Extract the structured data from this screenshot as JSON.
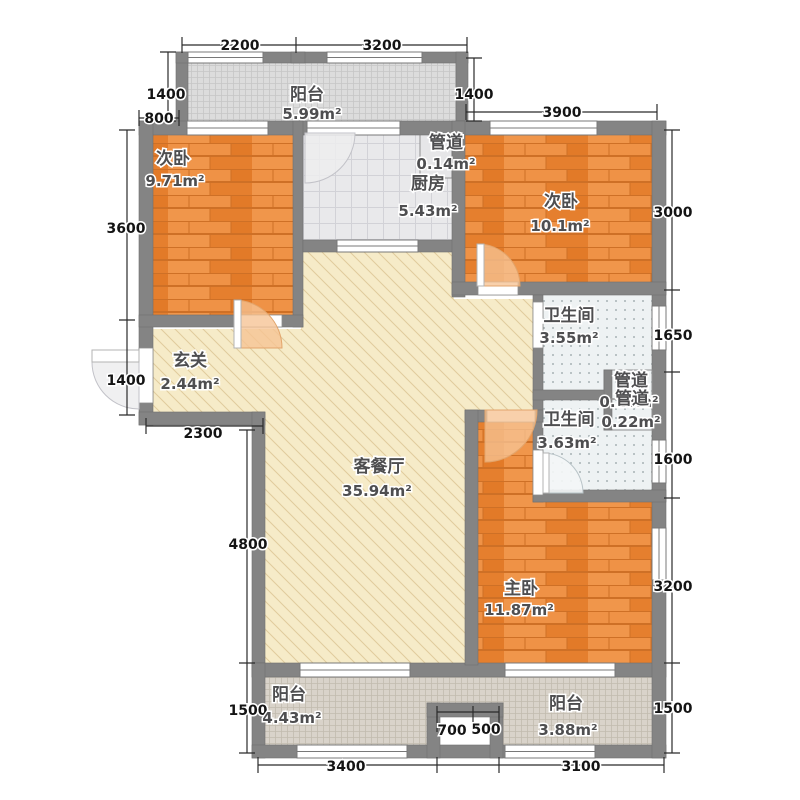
{
  "rooms": {
    "balcony_top": {
      "name": "阳台",
      "area": "5.99m²"
    },
    "bedroom_left": {
      "name": "次卧",
      "area": "9.71m²"
    },
    "duct_kitchen": {
      "name": "管道",
      "area": "0.14m²"
    },
    "kitchen": {
      "name": "厨房",
      "area": "5.43m²"
    },
    "bedroom_right": {
      "name": "次卧",
      "area": "10.1m²"
    },
    "bath_upper": {
      "name": "卫生间",
      "area": "3.55m²"
    },
    "duct_upper": {
      "name": "管道",
      "area": "0.18m²"
    },
    "duct_lower": {
      "name": "管道",
      "area": "0.22m²"
    },
    "bath_lower": {
      "name": "卫生间",
      "area": "3.63m²"
    },
    "entry": {
      "name": "玄关",
      "area": "2.44m²"
    },
    "living": {
      "name": "客餐厅",
      "area": "35.94m²"
    },
    "master": {
      "name": "主卧",
      "area": "11.87m²"
    },
    "balcony_bottom_left": {
      "name": "阳台",
      "area": "4.43m²"
    },
    "balcony_bottom_right": {
      "name": "阳台",
      "area": "3.88m²"
    }
  },
  "dims": {
    "top_left_w": "2200",
    "top_right_w": "3200",
    "balcony_left_h": "1400",
    "left_offset": "800",
    "bedroom_right_w": "3900",
    "balcony_right_h": "1400",
    "bedroom_left_h": "3600",
    "entry_left_h": "1400",
    "entry_w": "2300",
    "living_left_h": "4800",
    "balcony_bl_left_h": "1500",
    "right_bedroom_h": "3000",
    "right_bath_upper_h": "1650",
    "right_bath_lower_h": "1600",
    "right_master_h": "3200",
    "right_balcony_h": "1500",
    "bottom_left_w": "3400",
    "notch_left_w": "700",
    "notch_right_w": "500",
    "bottom_right_w": "3100"
  },
  "colors": {
    "wall": "#848484",
    "wood": "#EC8B3D",
    "living_fill": "#F6EBC8",
    "kitchen_tile": "#E9E9EB",
    "bath_fill": "#EEF2F3",
    "balcony_top_fill": "#DCDCDC",
    "balcony_bottom_fill": "#D9D3CA",
    "door_arc": "#F6C393"
  }
}
